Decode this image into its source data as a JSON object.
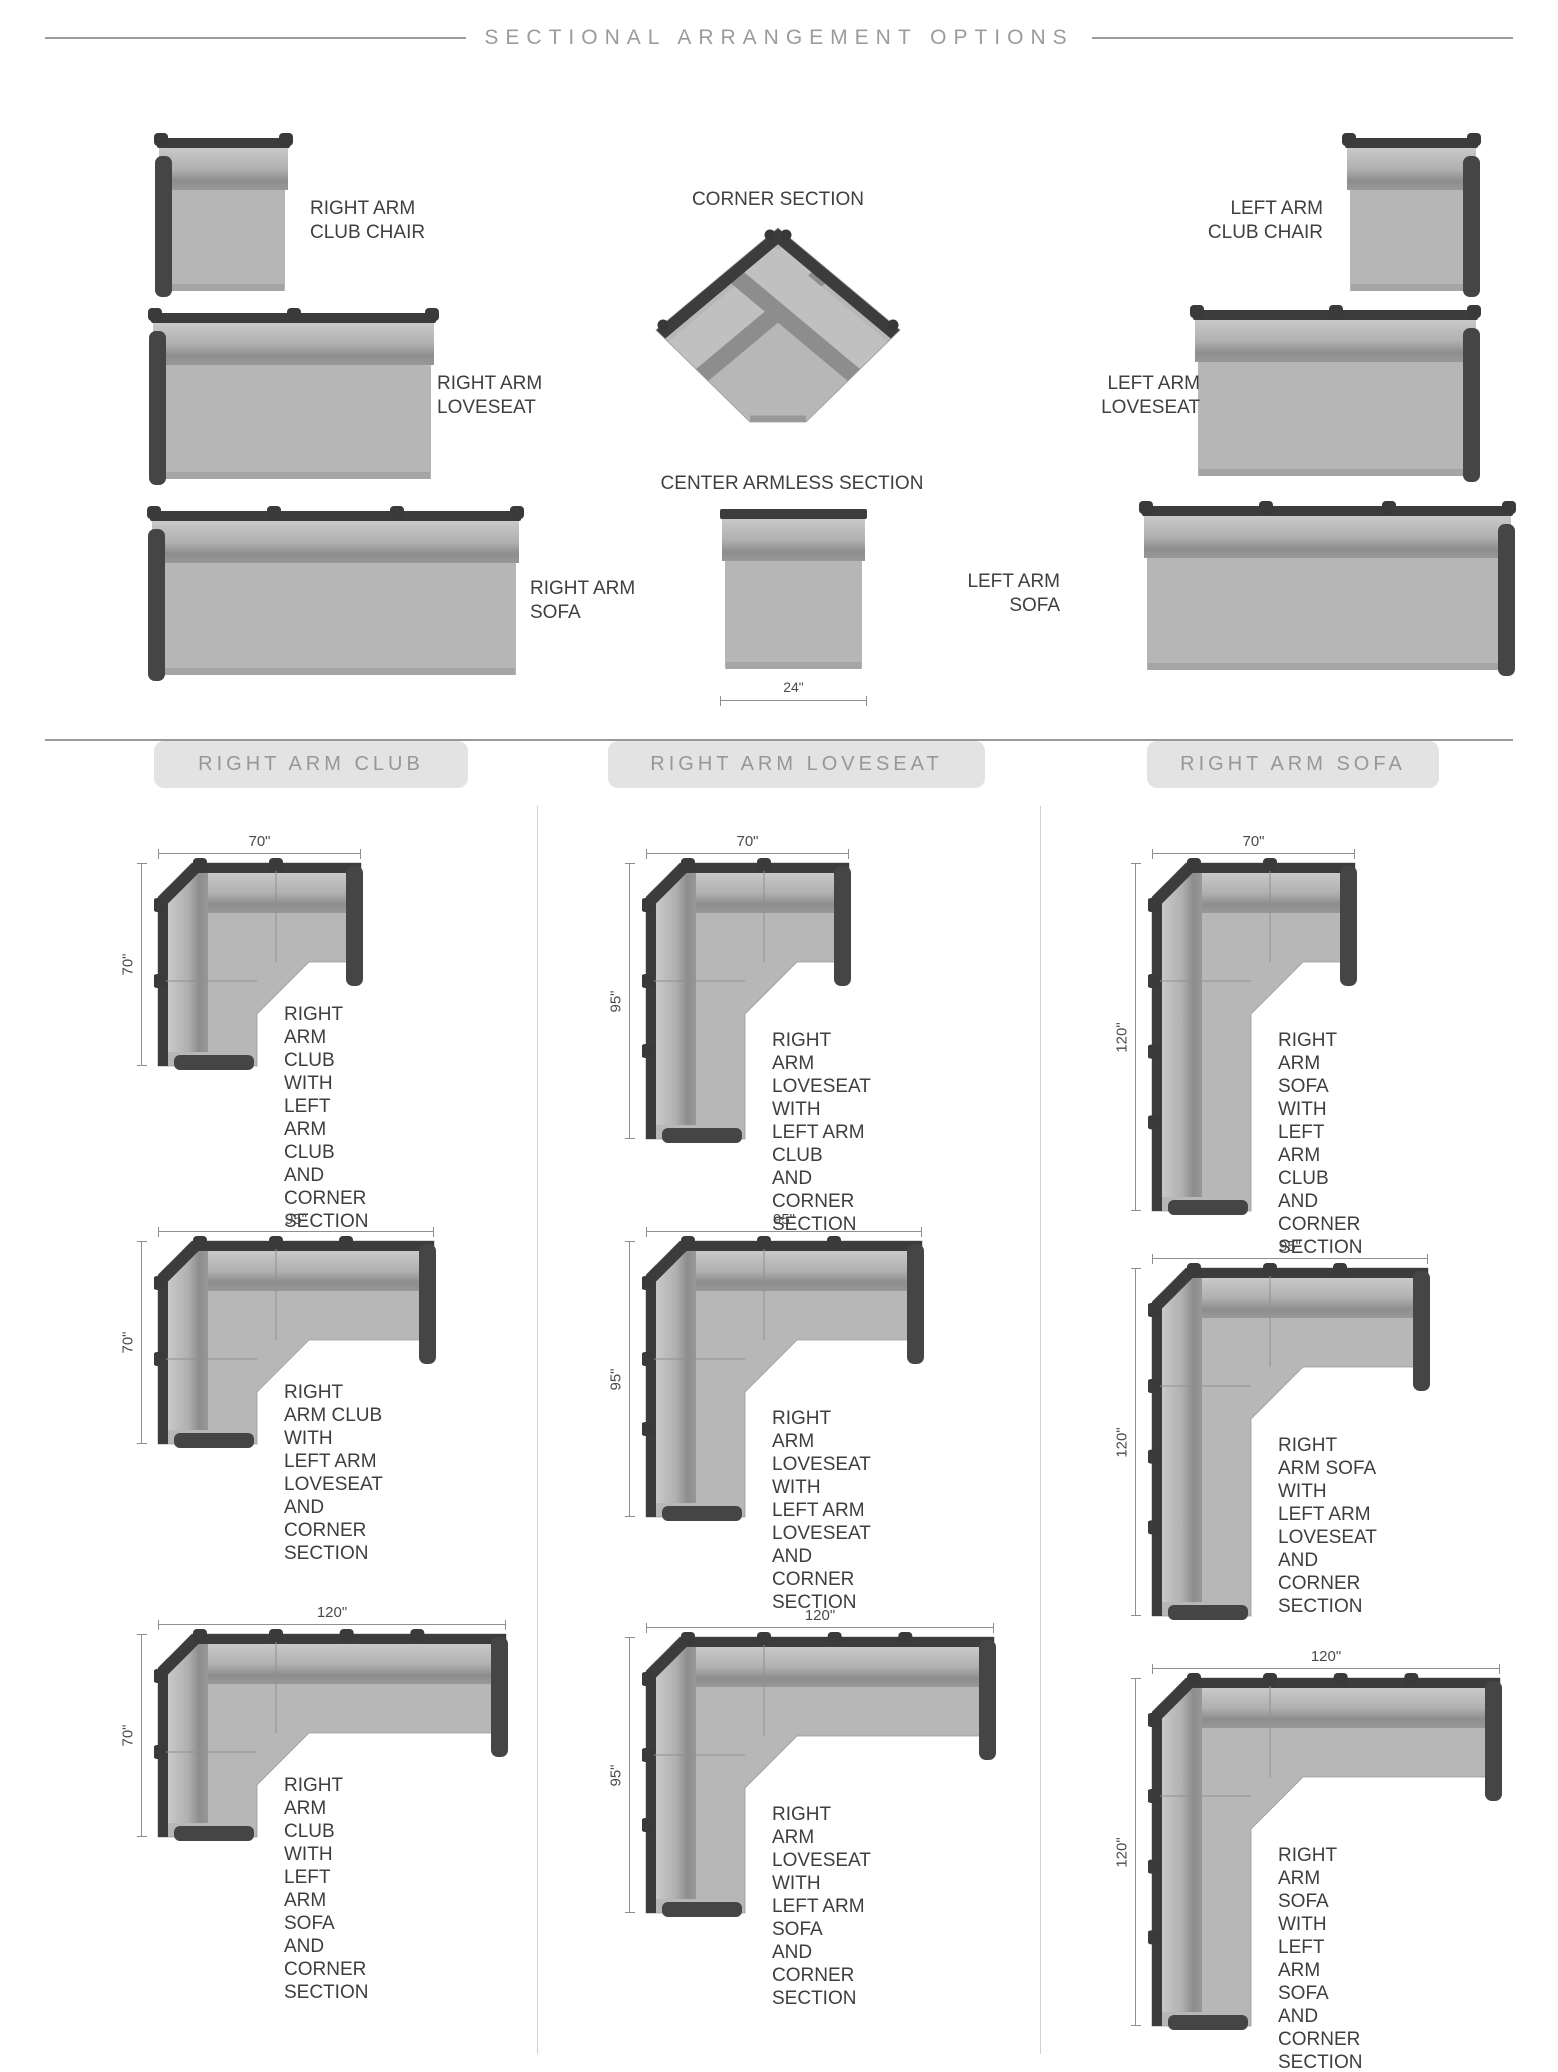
{
  "page_title": "SECTIONAL ARRANGEMENT OPTIONS",
  "overview": {
    "corner_label": "CORNER SECTION",
    "armless_label": "CENTER ARMLESS SECTION",
    "armless_width": "24\"",
    "right_pieces": [
      {
        "label": "RIGHT ARM\nCLUB CHAIR"
      },
      {
        "label": "RIGHT ARM\nLOVESEAT"
      },
      {
        "label": "RIGHT ARM\nSOFA"
      }
    ],
    "left_pieces": [
      {
        "label": "LEFT ARM\nCLUB CHAIR"
      },
      {
        "label": "LEFT ARM\nLOVESEAT"
      },
      {
        "label": "LEFT ARM\nSOFA"
      }
    ]
  },
  "sections": [
    {
      "header": "RIGHT ARM CLUB",
      "diagrams": [
        {
          "width": "70\"",
          "height": "70\"",
          "w_in": 70,
          "h_in": 70,
          "caption": "RIGHT ARM CLUB WITH\nLEFT ARM CLUB AND\nCORNER SECTION"
        },
        {
          "width": "95\"",
          "height": "70\"",
          "w_in": 95,
          "h_in": 70,
          "caption": "RIGHT ARM CLUB WITH\nLEFT ARM LOVESEAT\nAND CORNER SECTION"
        },
        {
          "width": "120\"",
          "height": "70\"",
          "w_in": 120,
          "h_in": 70,
          "caption": "RIGHT ARM CLUB\nWITH LEFT ARM SOFA\nAND CORNER SECTION"
        }
      ]
    },
    {
      "header": "RIGHT ARM LOVESEAT",
      "diagrams": [
        {
          "width": "70\"",
          "height": "95\"",
          "w_in": 70,
          "h_in": 95,
          "caption": "RIGHT ARM LOVESEAT\nWITH LEFT ARM CLUB\nAND CORNER SECTION"
        },
        {
          "width": "95\"",
          "height": "95\"",
          "w_in": 95,
          "h_in": 95,
          "caption": "RIGHT ARM LOVESEAT\nWITH LEFT ARM LOVESEAT\nAND CORNER SECTION"
        },
        {
          "width": "120\"",
          "height": "95\"",
          "w_in": 120,
          "h_in": 95,
          "caption": "RIGHT ARM LOVESEAT\nWITH LEFT ARM SOFA\nAND CORNER SECTION"
        }
      ]
    },
    {
      "header": "RIGHT ARM SOFA",
      "diagrams": [
        {
          "width": "70\"",
          "height": "120\"",
          "w_in": 70,
          "h_in": 120,
          "caption": "RIGHT ARM SOFA\nWITH LEFT ARM CLUB\nAND CORNER SECTION"
        },
        {
          "width": "95\"",
          "height": "120\"",
          "w_in": 95,
          "h_in": 120,
          "caption": "RIGHT ARM SOFA WITH\nLEFT ARM LOVESEAT\nAND CORNER SECTION"
        },
        {
          "width": "120\"",
          "height": "120\"",
          "w_in": 120,
          "h_in": 120,
          "caption": "RIGHT ARM SOFA\nWITH LEFT ARM SOFA\nAND CORNER SECTION"
        }
      ]
    }
  ],
  "colors": {
    "rail": "#3c3c3c",
    "arm": "#454545",
    "seat": "#b7b7b7",
    "band_light": "#c9c9c9",
    "band_dark": "#8d8d8d",
    "pill_bg": "#e3e3e3",
    "pill_text": "#979797",
    "title_text": "#9b9b9b",
    "caption_text": "#3e3e3e",
    "dim_line": "#8f8f8f"
  }
}
